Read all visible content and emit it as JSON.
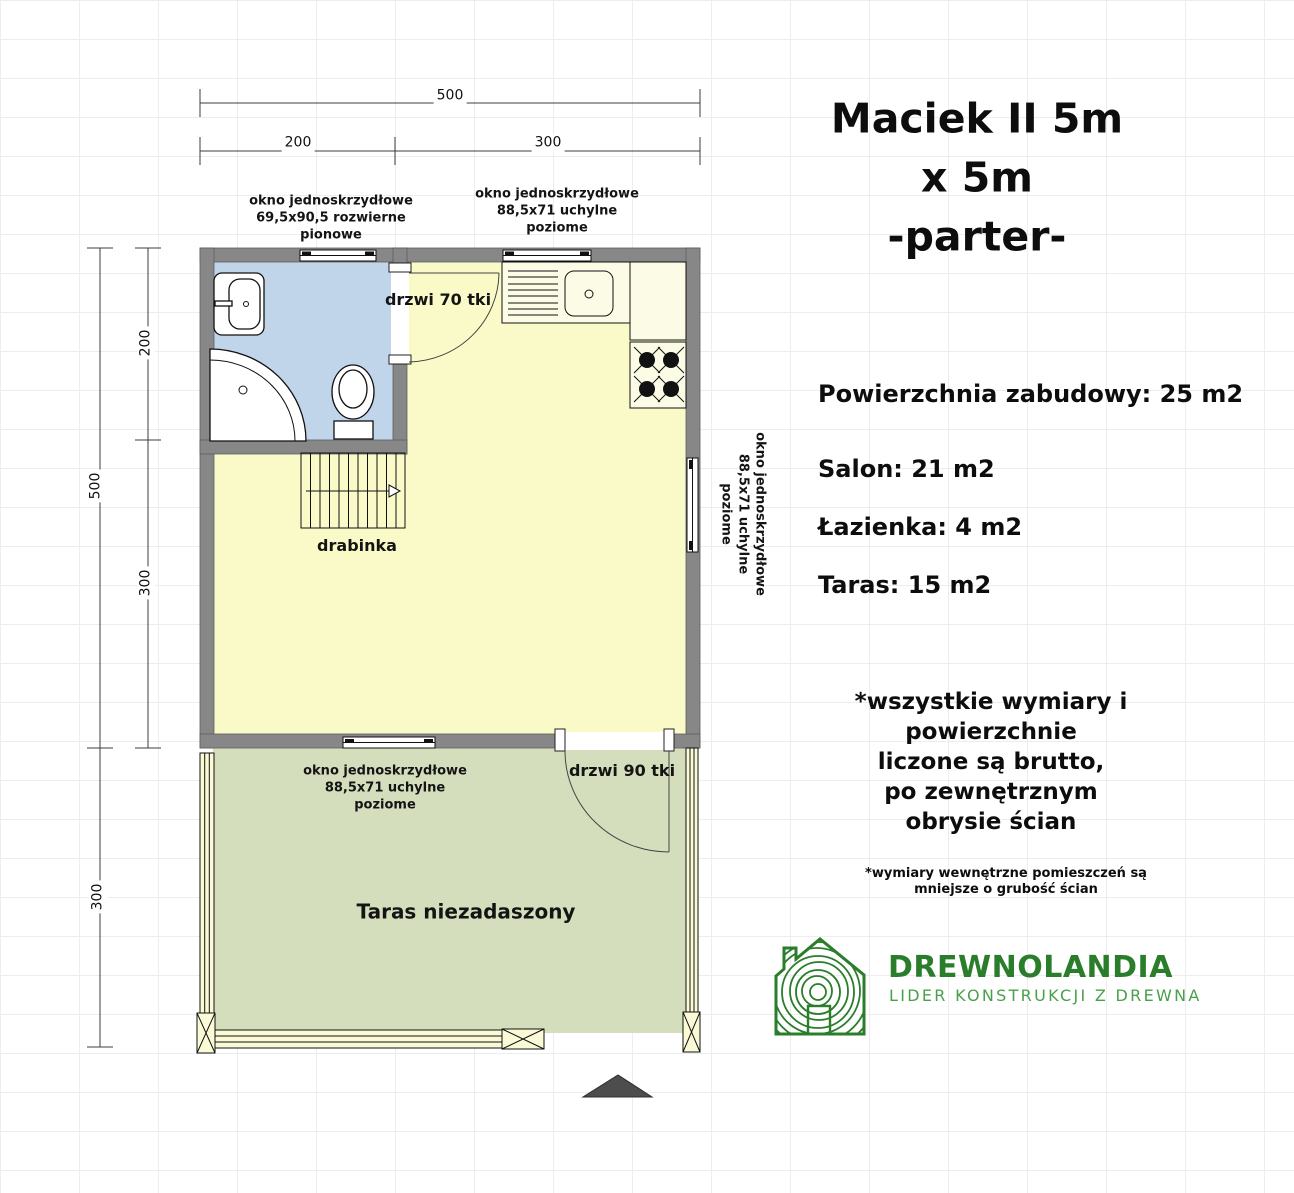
{
  "header": {
    "title_line1": "Maciek II 5m x 5m",
    "title_line2": "-parter-",
    "title": "Maciek II 5m x 5m\n-parter-"
  },
  "dims": {
    "top_total": "500",
    "top_left": "200",
    "top_right": "300",
    "left_total": "500",
    "left_upper": "200",
    "left_lower": "300",
    "terrace_height": "300"
  },
  "plan": {
    "window_bathroom_label": "okno jednoskrzydłowe\n69,5x90,5 rozwierne\npionowe",
    "window_kitchen_label": "okno jednoskrzydłowe\n88,5x71 uchylne\npoziome",
    "window_right_label": "okno jednoskrzydłowe\n88,5x71 uchylne\npoziome",
    "window_terrace_label": "okno jednoskrzydłowe\n88,5x71 uchylne\npoziome",
    "door_bathroom_label": "drzwi 70 tki",
    "door_terrace_label": "drzwi 90 tki",
    "stairs_label": "drabinka",
    "terrace_label": "Taras niezadaszony"
  },
  "areas": {
    "total": "Powierzchnia zabudowy: 25 m2",
    "salon": "Salon: 21 m2",
    "bathroom": "Łazienka: 4 m2",
    "terrace": "Taras: 15 m2"
  },
  "notes": {
    "gross": "*wszystkie wymiary i powierzchnie\nliczone są brutto,\npo zewnętrznym obrysie ścian",
    "internal": "*wymiary wewnętrzne pomieszczeń są mniejsze o grubość ścian"
  },
  "logo": {
    "name": "DREWNOLANDIA",
    "tagline": "LIDER KONSTRUKCJI Z DREWNA"
  },
  "colors": {
    "wall": "#878787",
    "bathroom_floor": "#c0d4ea",
    "salon_floor": "#fafac9",
    "terrace_floor": "#d5debc",
    "counter": "#fcfce6",
    "railing": "#fbfad6",
    "logo_green": "#2a7d2b",
    "logo_green_light": "#49a04a",
    "north_arrow": "#4d4d4d"
  }
}
